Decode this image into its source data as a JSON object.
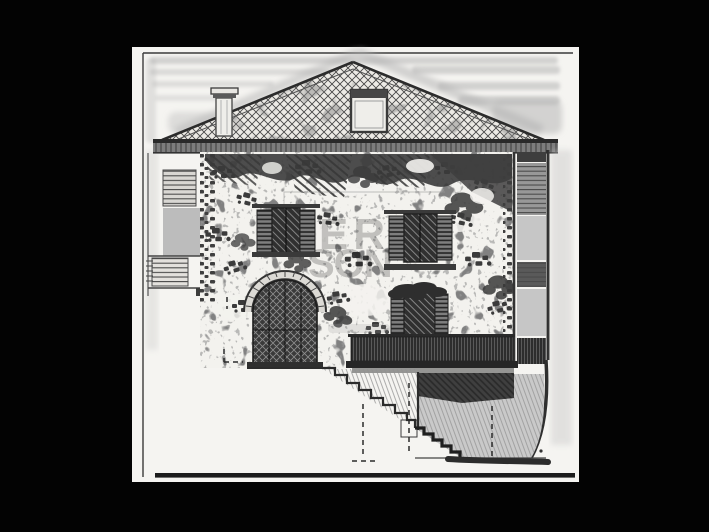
{
  "figure": {
    "kind": "scanned architectural elevation drawing",
    "subject": "Front elevation of a two-storey rustic stone house: hipped clay-tile roof with chimney and roof window, deep eaves shadow, rubble-stone facade, two shuttered casement windows, lower shuttered window with planting box, round-arched entrance door with stone voussoirs, balcony with dense railing, external staircase descending to the right over a hatched embankment, dashed hidden lines, heavy ground line",
    "paper_color": "#f5f4f1",
    "frame_color": "#000000",
    "ink_color": "#2b2b2b",
    "shading_color": "#b7b7b7"
  },
  "watermark": {
    "line1": "ER",
    "line2": "SON",
    "color": "#bdbdbd"
  }
}
